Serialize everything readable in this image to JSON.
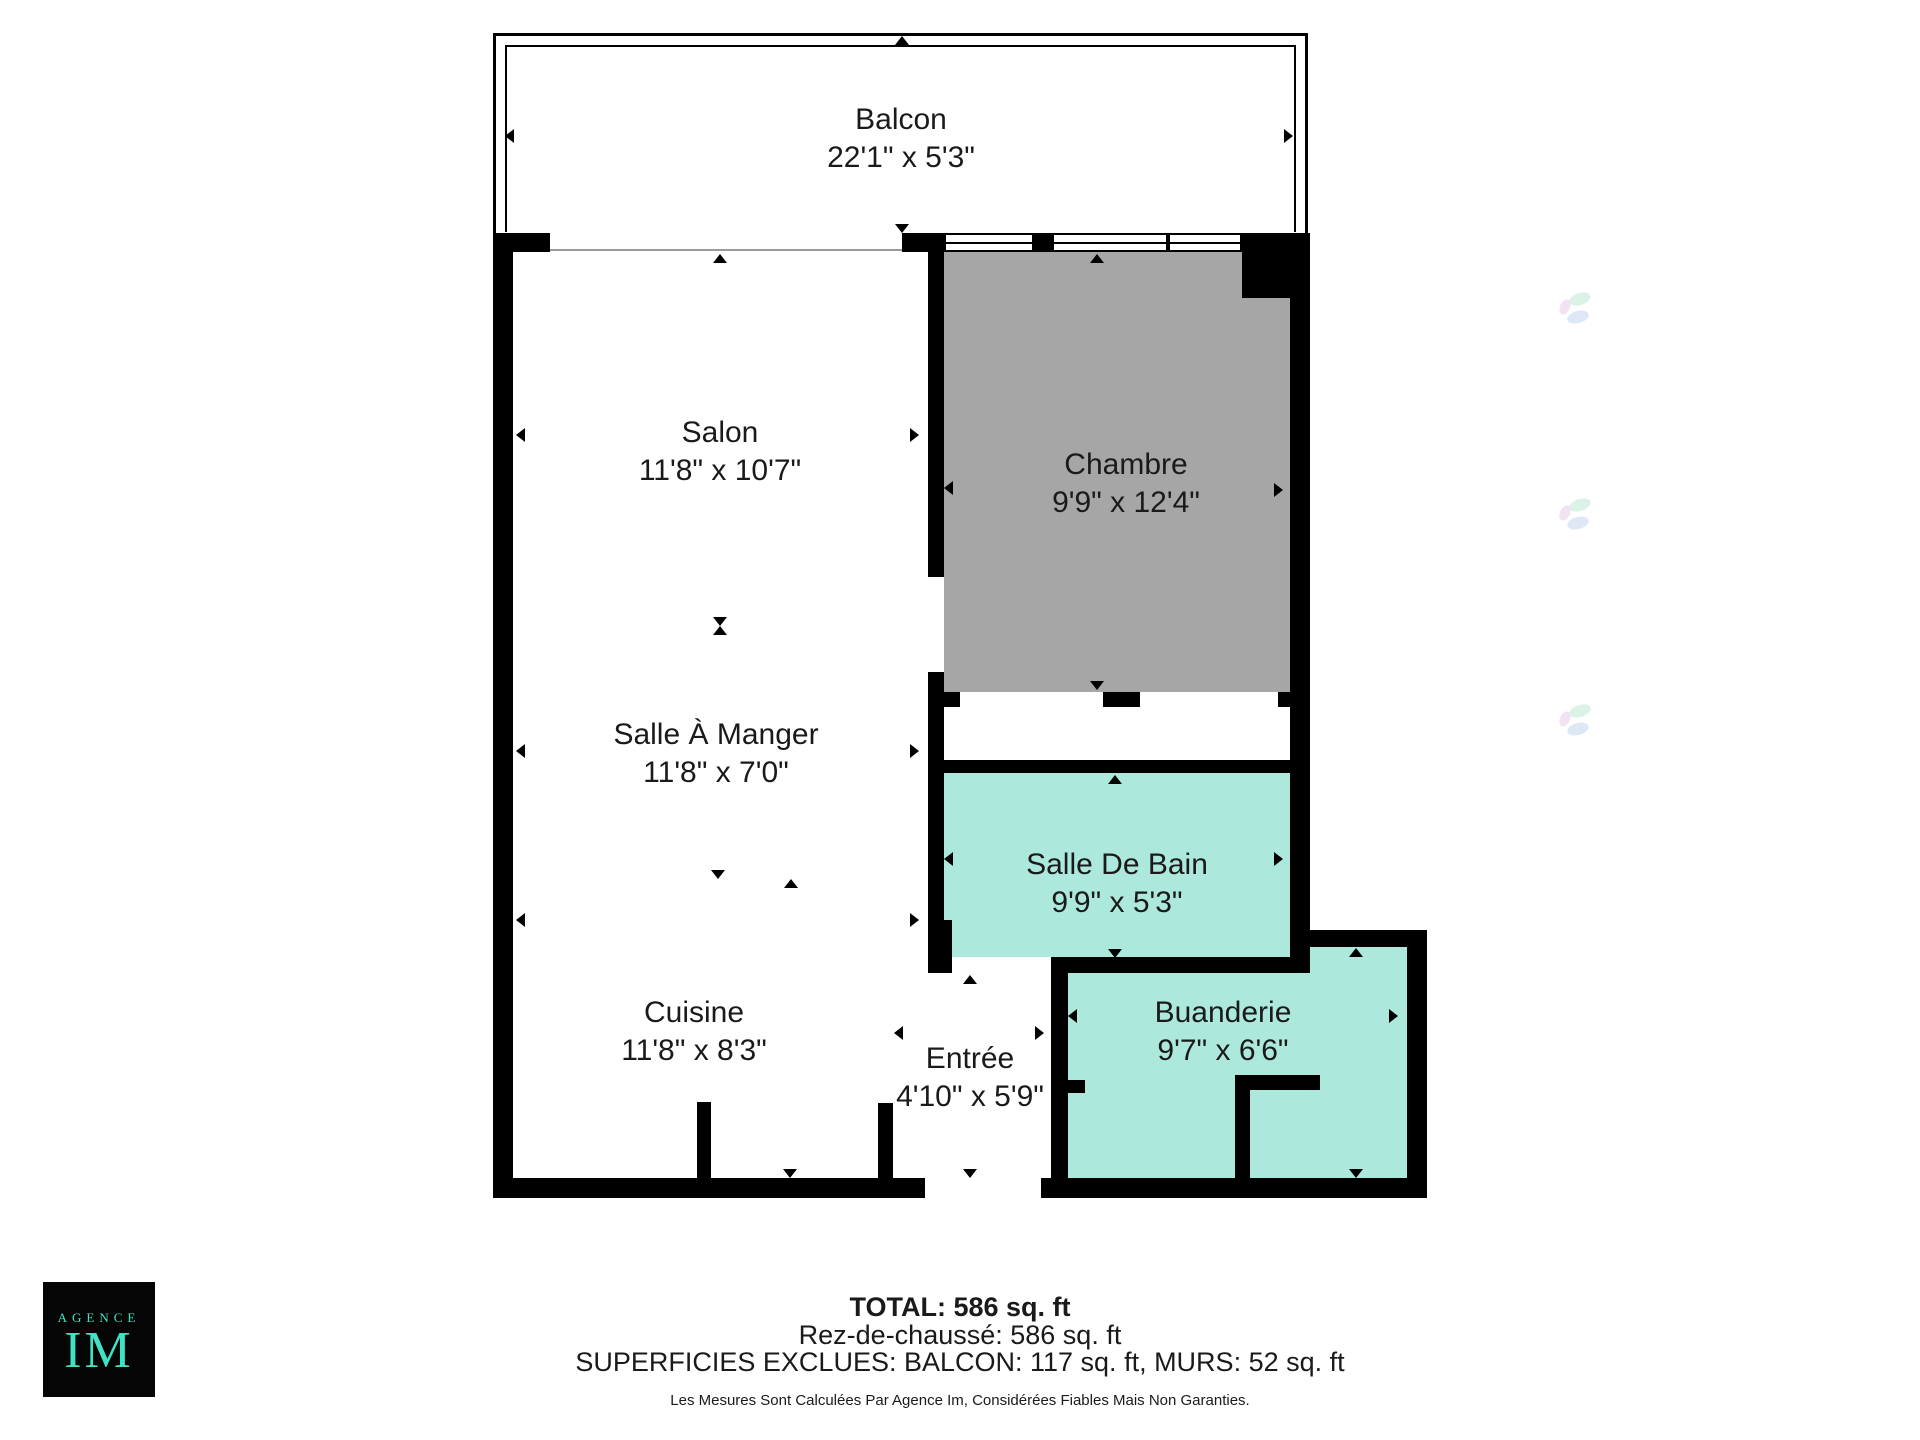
{
  "rooms": [
    {
      "name": "Balcon",
      "dims": "22'1\" x 5'3\""
    },
    {
      "name": "Salon",
      "dims": "11'8\" x 10'7\""
    },
    {
      "name": "Chambre",
      "dims": "9'9\" x 12'4\""
    },
    {
      "name": "Salle À Manger",
      "dims": "11'8\" x 7'0\""
    },
    {
      "name": "Salle De Bain",
      "dims": "9'9\" x 5'3\""
    },
    {
      "name": "Cuisine",
      "dims": "11'8\" x 8'3\""
    },
    {
      "name": "Entrée",
      "dims": "4'10\" x 5'9\""
    },
    {
      "name": "Buanderie",
      "dims": "9'7\" x 6'6\""
    }
  ],
  "summary": {
    "total": "TOTAL: 586 sq. ft",
    "floor": "Rez-de-chaussé: 586 sq. ft",
    "excluded": "SUPERFICIES EXCLUES: BALCON: 117 sq. ft, MURS: 52 sq. ft",
    "disclaimer": "Les Mesures Sont Calculées Par Agence Im, Considérées Fiables Mais Non Garanties."
  },
  "logo": {
    "top": "AGENCE",
    "main": "IM"
  },
  "colors": {
    "wall": "#000000",
    "bedroom_fill": "#a6a6a6",
    "wet_room_fill": "#ace9dc",
    "logo_background": "#050505",
    "logo_teal": "#3fe3c3",
    "text": "#1a1a1a"
  }
}
